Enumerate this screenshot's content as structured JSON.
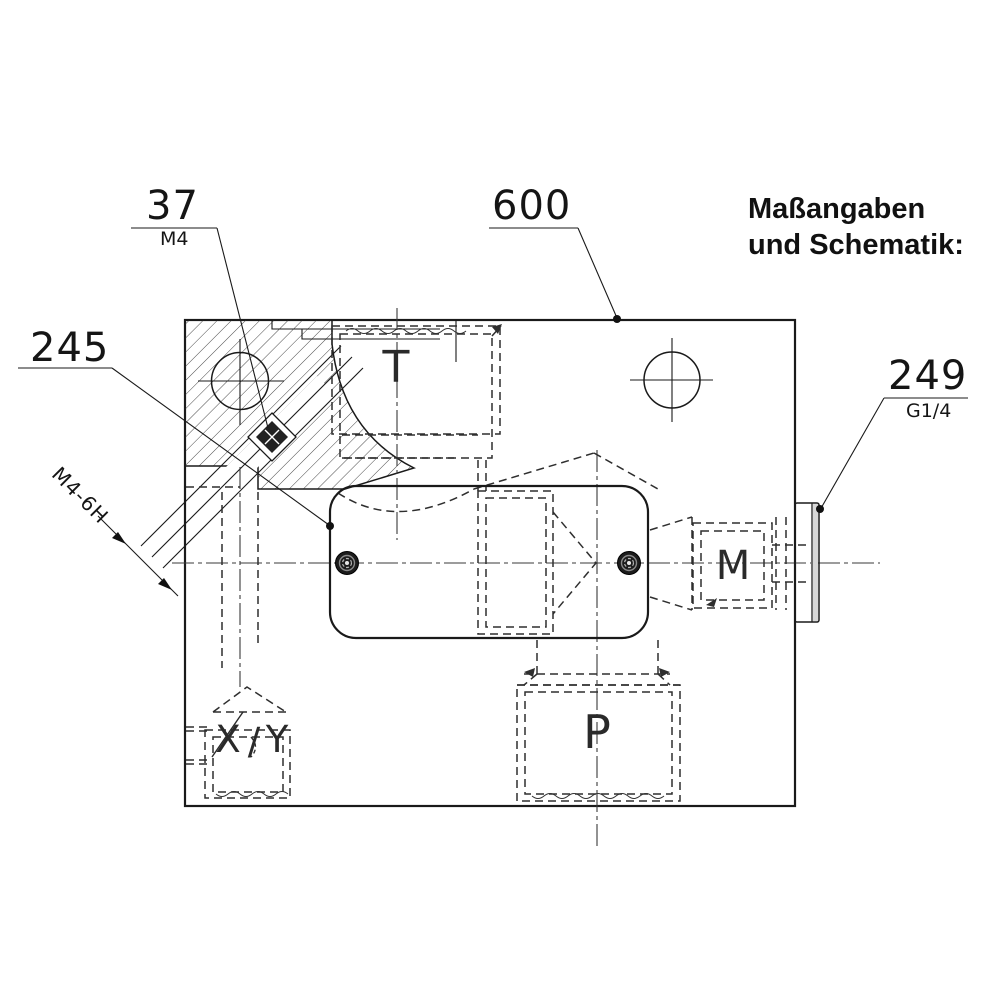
{
  "heading": {
    "line1": "Maßangaben",
    "line2": "und Schematik:"
  },
  "dimensions": {
    "d37": {
      "value": "37",
      "sub": "M4"
    },
    "d600": {
      "value": "600"
    },
    "d245": {
      "value": "245"
    },
    "d249": {
      "value": "249",
      "sub": "G1/4"
    },
    "thread_callout": {
      "value": "M4-6H"
    }
  },
  "ports": {
    "t": "T",
    "p": "P",
    "m": "M",
    "x": "X",
    "slash": "/",
    "y": "Y"
  },
  "colors": {
    "background": "#ffffff",
    "line": "#1a1a1a",
    "text": "#111111",
    "screw_fill": "#1c1c1c",
    "plug_shade": "#d8d8d8"
  }
}
